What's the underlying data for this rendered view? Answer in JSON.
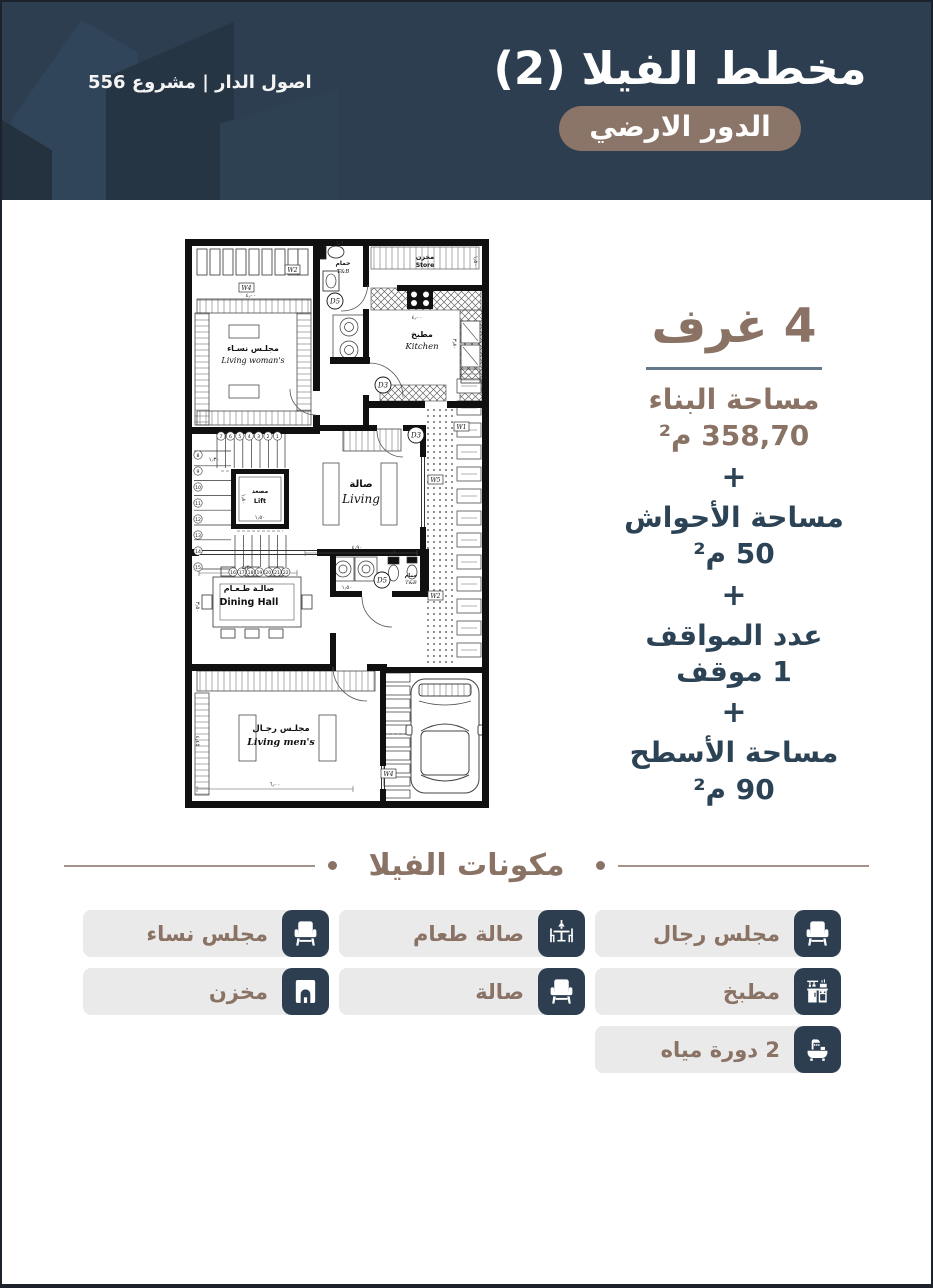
{
  "colors": {
    "navy": "#2C3E50",
    "brown": "#8A7365",
    "badge": "#8B7468",
    "chip_bg": "#EAEAEA",
    "divider": "#64788A",
    "heading_line": "#A4938A"
  },
  "header": {
    "title": "مخطط الفيلا (2)",
    "badge": "الدور الارضي",
    "brand": "اصول الدار | مشروع 556"
  },
  "stats": {
    "rooms_title": "4 غرف",
    "plus": "+",
    "items": [
      {
        "label": "مساحة البناء",
        "value": "358,70 م²"
      },
      {
        "label": "مساحة الأحواش",
        "value": "50 م²"
      },
      {
        "label": "عدد المواقف",
        "value": "1 موقف"
      },
      {
        "label": "مساحة الأسطح",
        "value": "90 م²"
      }
    ]
  },
  "components": {
    "title": "مكونات الفيلا",
    "items": [
      {
        "label": "مجلس رجال",
        "icon": "chair-icon"
      },
      {
        "label": "صالة طعام",
        "icon": "dining-icon"
      },
      {
        "label": "مجلس نساء",
        "icon": "chair-icon"
      },
      {
        "label": "مطبخ",
        "icon": "kitchen-icon"
      },
      {
        "label": "صالة",
        "icon": "chair-icon"
      },
      {
        "label": "مخزن",
        "icon": "storage-icon"
      },
      {
        "label": "2 دورة مياه",
        "icon": "bath-icon"
      }
    ]
  },
  "floorplan": {
    "rooms": {
      "living_womans": {
        "ar": "مجلـس نسـاء",
        "en": "Living woman's"
      },
      "bath_top": {
        "ar": "حمام",
        "en": "T&B"
      },
      "store": {
        "ar": "مخزن",
        "en": "Store"
      },
      "kitchen": {
        "ar": "مطبخ",
        "en": "Kitchen"
      },
      "lift": {
        "ar": "مصعد",
        "en": "Lift"
      },
      "living_hall": {
        "ar": "صالة",
        "en": "Living"
      },
      "dining": {
        "ar": "صالـة طـعـام",
        "en": "Dining Hall"
      },
      "bath_mid": {
        "ar": "حمام",
        "en": "T&B"
      },
      "living_mens": {
        "ar": "مجلـس رجـال",
        "en": "Living men's"
      }
    },
    "doors": {
      "d5a": "D5",
      "d3a": "D3",
      "d3b": "D3",
      "d5b": "D5"
    },
    "windows": {
      "w1": "W1",
      "w2a": "W2",
      "w2b": "W2",
      "w4a": "W4",
      "w4b": "W4",
      "w5": "W5"
    },
    "dims": {
      "top_bath": "١٫٦٠",
      "womans_w": "٤٫٠٠",
      "store_d": "١٫٥٠",
      "kitchen_w": "٤٫٠٠",
      "kitchen_d": "٣٫٨٠",
      "hall_w": "٤٫٩٠",
      "stair_w": "١٫٣٠",
      "lift_w": "١٫٥٠",
      "lift_d": "١٫٨٠",
      "dining_w": "٤٫٣٠",
      "dining_d": "٣٫٥٠",
      "bath_w": "١٫٥٠",
      "bath_s": "٠٫٨",
      "mens_w": "٦٫٠٠",
      "mens_d": "٤٫٤٥"
    },
    "stairs_top": [
      "7",
      "6",
      "5",
      "4",
      "3",
      "2",
      "1"
    ],
    "stairs_left": [
      "8",
      "9",
      "10",
      "11",
      "12",
      "13",
      "14",
      "15"
    ],
    "stairs_bottom": [
      "16",
      "17",
      "18",
      "19",
      "20",
      "21",
      "22"
    ]
  }
}
